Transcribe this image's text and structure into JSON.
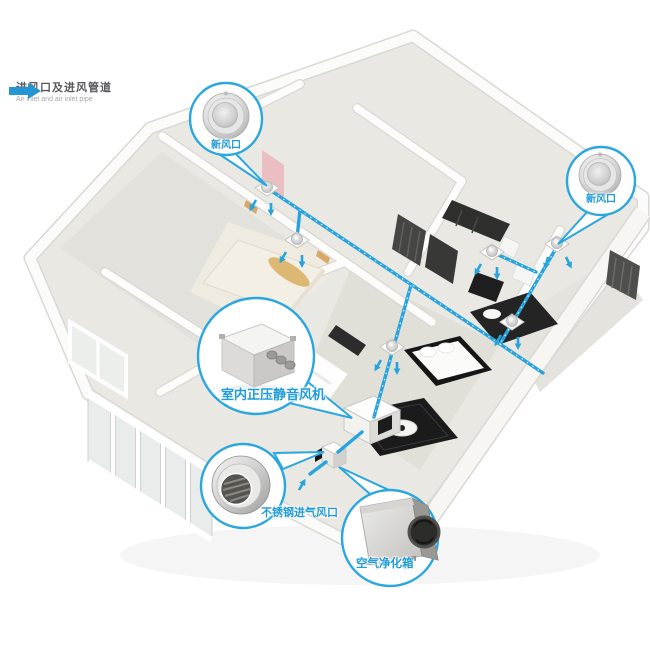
{
  "page": {
    "description": "Isometric cutaway home illustration showing a fresh-air ventilation system with blue air-inlet piping"
  },
  "legend": {
    "icon": "air-inlet-arrow",
    "title": "进风口及进风管道",
    "subtitle": "Air inlet and air inlet pipe"
  },
  "callouts": {
    "fresh_air_top": {
      "label": "新风口",
      "image": "round-fresh-air-vent"
    },
    "fresh_air_right": {
      "label": "新风口",
      "image": "round-fresh-air-vent"
    },
    "indoor_fan": {
      "label": "室内正压静音风机",
      "image": "inline-duct-fan-unit"
    },
    "stainless_intake": {
      "label": "不锈钢进气风口",
      "image": "stainless-steel-intake-vent"
    },
    "air_purifier": {
      "label": "空气净化箱",
      "image": "air-purification-box"
    }
  },
  "colors": {
    "accent_blue": "#29a3dc",
    "label_blue": "#1f9cd9",
    "legend_text": "#58595b",
    "legend_subtext": "#a5a7aa",
    "wall_white": "#fbfbfa",
    "floor_gray": "#e8e7e2",
    "furniture_dark": "#222222",
    "accent_pink": "#ebbfc1",
    "accent_tan": "#ddb873"
  }
}
